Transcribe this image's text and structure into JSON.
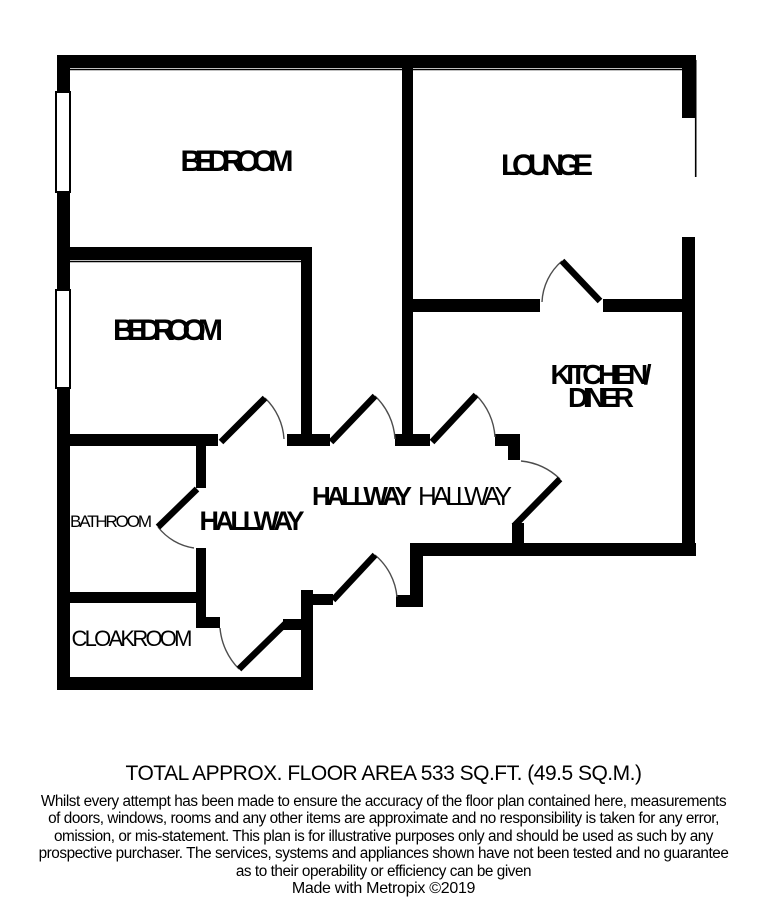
{
  "plan": {
    "labels": {
      "bedroom1": "BEDROOM",
      "lounge": "LOUNGE",
      "bedroom2": "BEDROOM",
      "kitchen_line1": "KITCHEN/",
      "kitchen_line2": "DINER",
      "hallway_a": "HALLWAY",
      "hallway_b": "HALLWAY",
      "hallway_c": "HALLWAY",
      "bathroom": "BATHROOM",
      "cloakroom": "CLOAKROOM"
    },
    "colors": {
      "wall": "#000000",
      "background": "#ffffff",
      "door_arc": "#4d4d4d"
    }
  },
  "footer": {
    "area_line": "TOTAL APPROX. FLOOR AREA 533 SQ.FT. (49.5 SQ.M.)",
    "disclaimer_lines": [
      "Whilst every attempt has been made to ensure the accuracy of the floor plan contained here, measurements",
      "of doors, windows, rooms and any other items are approximate and no responsibility is taken for any error,",
      "omission, or mis-statement. This plan is for illustrative purposes only and should be used as such by any",
      "prospective purchaser. The services, systems and appliances shown have not been tested and no guarantee",
      "as to their operability or efficiency can be given"
    ],
    "credit": "Made with Metropix ©2019"
  }
}
